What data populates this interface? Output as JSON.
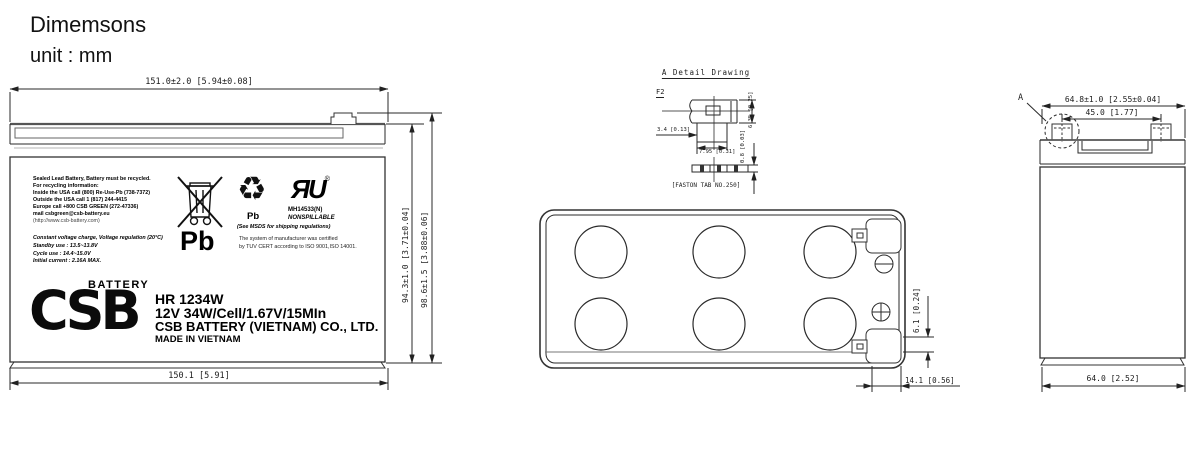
{
  "header": {
    "title": "Dimemsons",
    "unit": "unit : mm"
  },
  "front_view": {
    "dim_width_top": "151.0±2.0 [5.94±0.08]",
    "dim_width_bottom": "150.1 [5.91]",
    "dim_height_case": "94.3±1.0 [3.71±0.04]",
    "dim_height_total": "98.6±1.5 [3.88±0.06]",
    "label": {
      "recycle_lines": [
        "Sealed Lead Battery, Battery must be recycled.",
        "For recycling information:",
        "Inside  the USA call (800) Re-Use-Pb (738-7372)",
        "Outside the USA call 1 (817) 244-4415",
        "Europe call  +800 CSB GREEN (272-47336)",
        "mail   csbgreen@csb-battery.eu",
        "(http://www.csb-battery.com)"
      ],
      "charge_lines": [
        "Constant voltage charge, Voltage regulation (20°C)",
        "Standby use : 13.5~13.8V",
        "Cycle use    : 14.4~15.0V",
        "Initial current : 2.16A MAX."
      ],
      "pb_large": "Pb",
      "pb_small": "Pb",
      "recycle_glyph": "♻",
      "ul_glyph": "ЯU",
      "ul_reg": "®",
      "ul_code": "MH14533(N)",
      "nonspillable": "NONSPILLABLE",
      "msds_note": "(See MSDS for shipping regulations)",
      "cert_line1": "The system of manufacturer was certified",
      "cert_line2": "by TUV CERT according to ISO 9001,ISO 14001.",
      "brand_top": "BATTERY",
      "brand_logo": "CSB",
      "model": "HR 1234W",
      "spec": "12V 34W/Cell/1.67V/15MIn",
      "company": "CSB BATTERY (VIETNAM) CO., LTD.",
      "made_in": "MADE IN VIETNAM"
    }
  },
  "detail_drawing": {
    "title": "A Detail Drawing",
    "section_label": "F2",
    "dim_tab_offset": "3.4 [0.13]",
    "dim_tab_length": "7.95 [0.31]",
    "dim_tab_width": "6.35 [0.25]",
    "dim_tab_thickness": "0.8 [0.03]",
    "caption": "[FASTON TAB NO.250]"
  },
  "top_view": {
    "dim_terminal_offset": "6.1 [0.24]",
    "dim_terminal_inset": "14.1 [0.56]"
  },
  "side_view": {
    "detail_label": "A",
    "dim_width_top": "64.8±1.0 [2.55±0.04]",
    "dim_terminal_spacing": "45.0 [1.77]",
    "dim_width_bottom": "64.0 [2.52]"
  }
}
